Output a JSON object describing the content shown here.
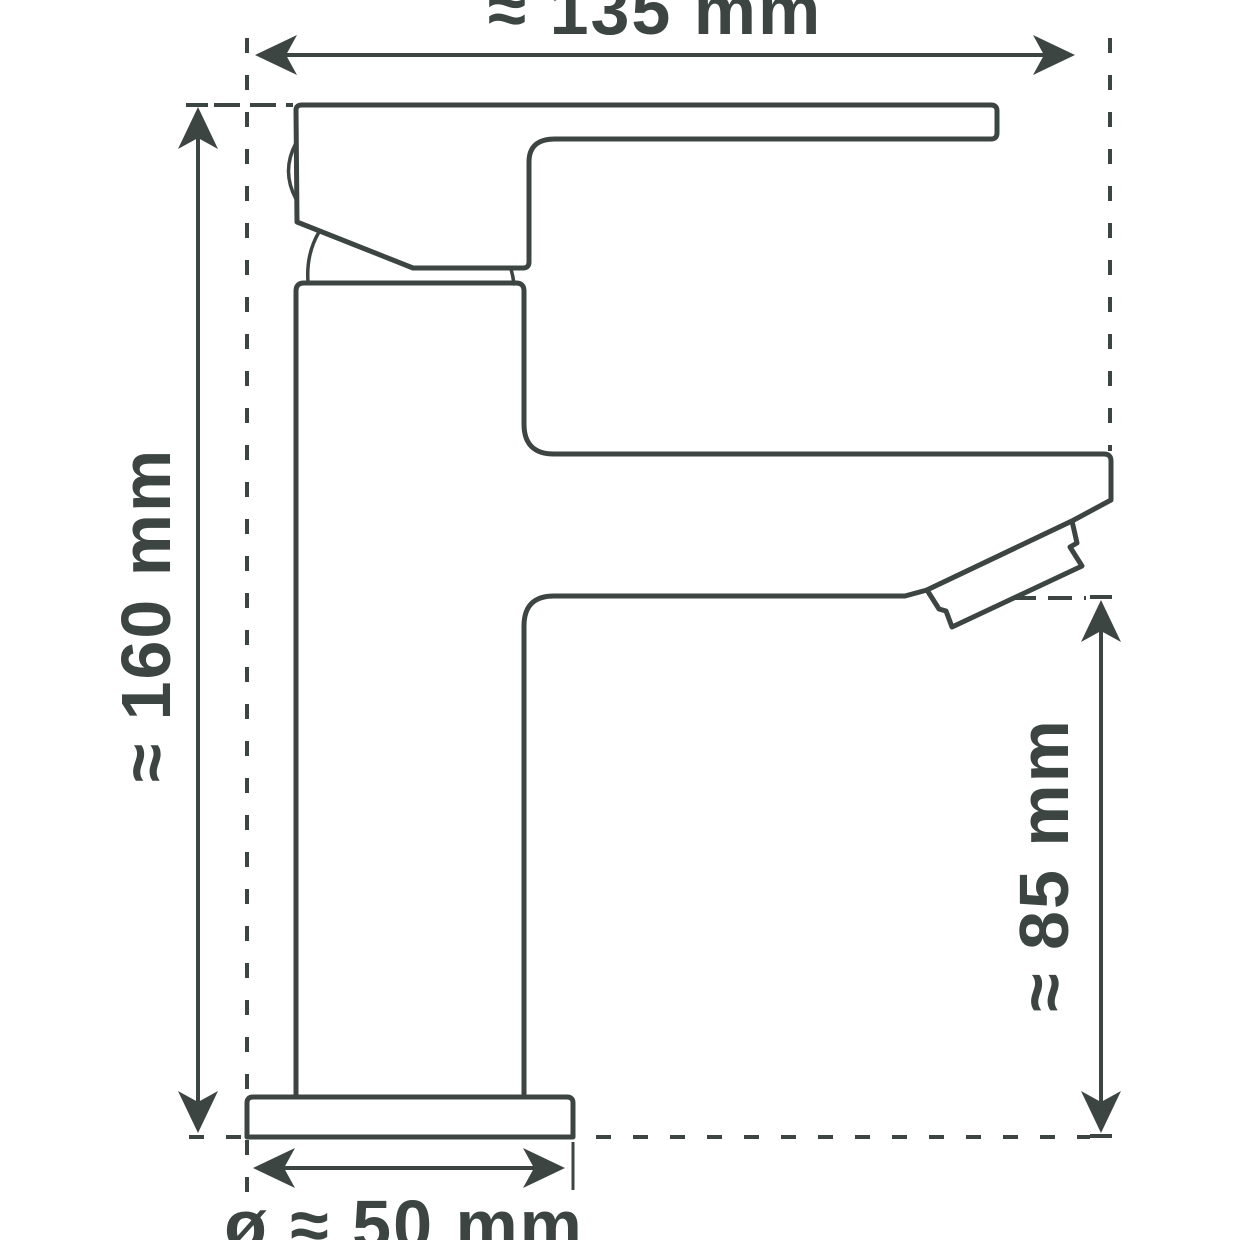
{
  "diagram": {
    "type": "technical-dimension-drawing",
    "subject": "single-lever basin mixer tap, side view",
    "line_color": "#3c4542",
    "background_color": "#ffffff",
    "labels": {
      "overall_width": "≈ 135 mm",
      "overall_height": "≈ 160 mm",
      "spout_height": "≈ 85 mm",
      "base_diameter": "ø ≈ 50 mm"
    },
    "measurements": {
      "overall_width_mm": 135,
      "overall_height_mm": 160,
      "spout_height_mm": 85,
      "base_diameter_mm": 50,
      "tolerance": "approximate"
    }
  }
}
